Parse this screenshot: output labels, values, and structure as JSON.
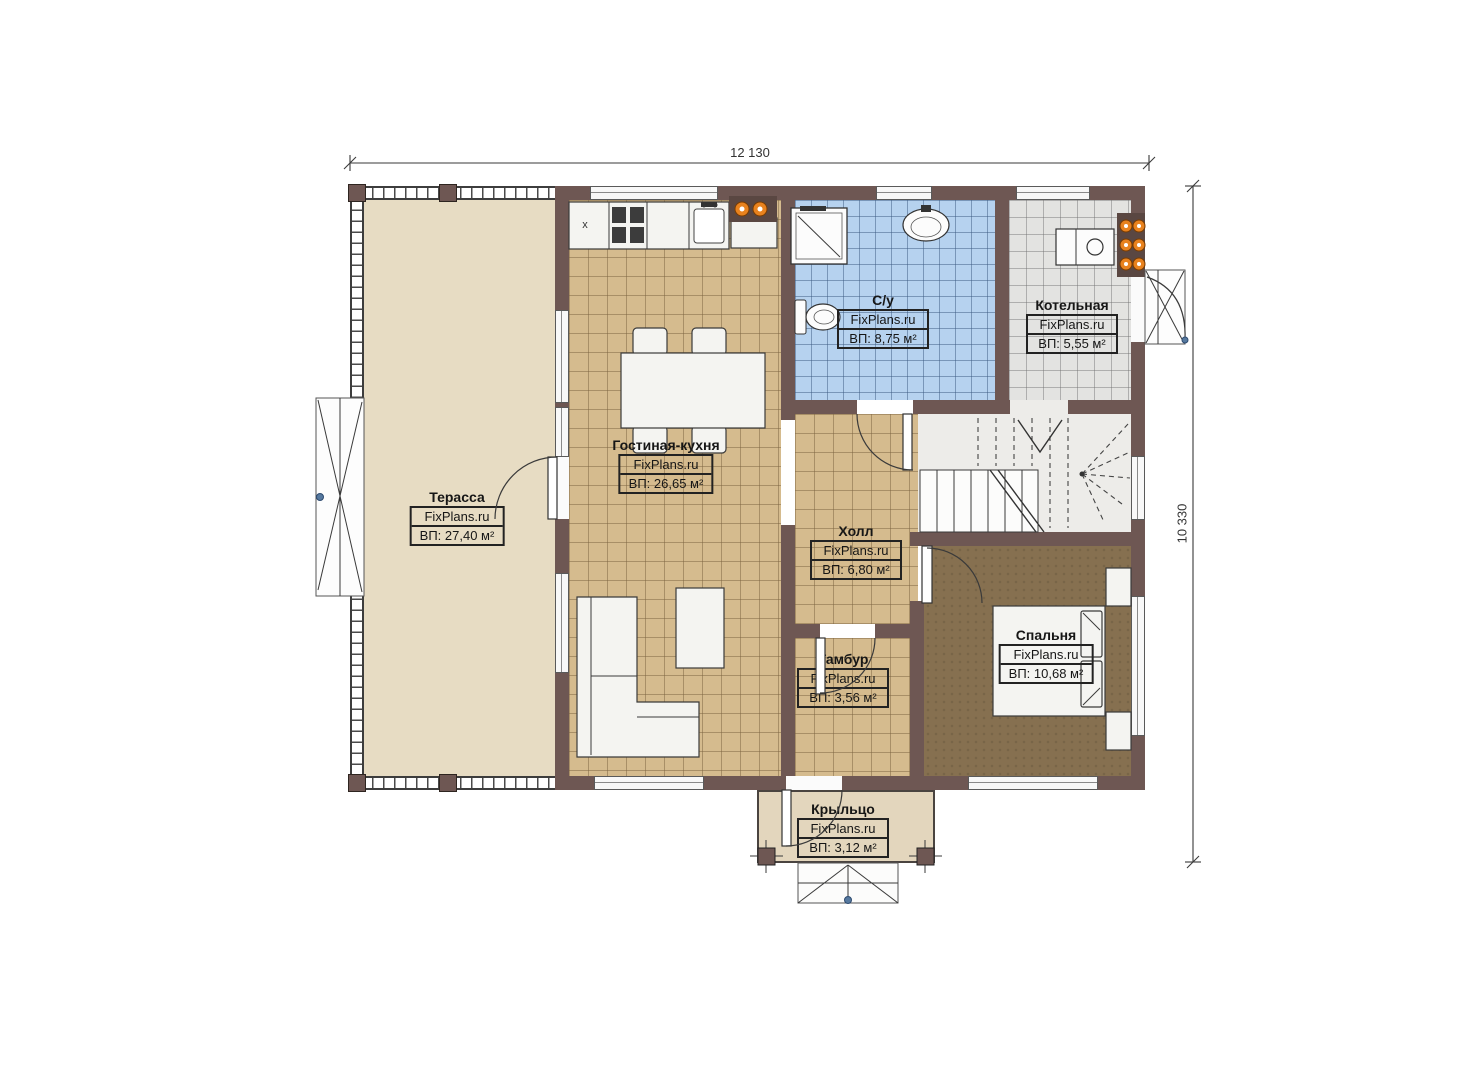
{
  "brand": "FixPlans.ru",
  "dimensions": {
    "width_label": "12 130",
    "height_label": "10 330"
  },
  "rooms": {
    "terrace": {
      "name": "Терасса",
      "area": "ВП: 27,40 м²"
    },
    "living_kitchen": {
      "name": "Гостиная-кухня",
      "area": "ВП: 26,65 м²"
    },
    "bathroom": {
      "name": "С/у",
      "area": "ВП: 8,75 м²"
    },
    "boiler": {
      "name": "Котельная",
      "area": "ВП: 5,55 м²"
    },
    "hall": {
      "name": "Холл",
      "area": "ВП: 6,80 м²"
    },
    "bedroom": {
      "name": "Спальня",
      "area": "ВП: 10,68 м²"
    },
    "vestibule": {
      "name": "Тамбур",
      "area": "ВП: 3,56 м²"
    },
    "porch": {
      "name": "Крыльцо",
      "area": "ВП: 3,12 м²"
    }
  },
  "kitchen": {
    "fridge_mark": "x"
  },
  "colors": {
    "wall": "#6e5753",
    "floor_tile_tan": "#d5bb8e",
    "floor_tile_blue": "#b6d2ef",
    "floor_tile_gray": "#e3e3e1",
    "floor_bedroom": "#867050",
    "floor_terrace": "#e7dcc3",
    "floor_porch": "#e3d6bd",
    "radiator_orange": "#e8821e",
    "marker_blue": "#56799f"
  }
}
